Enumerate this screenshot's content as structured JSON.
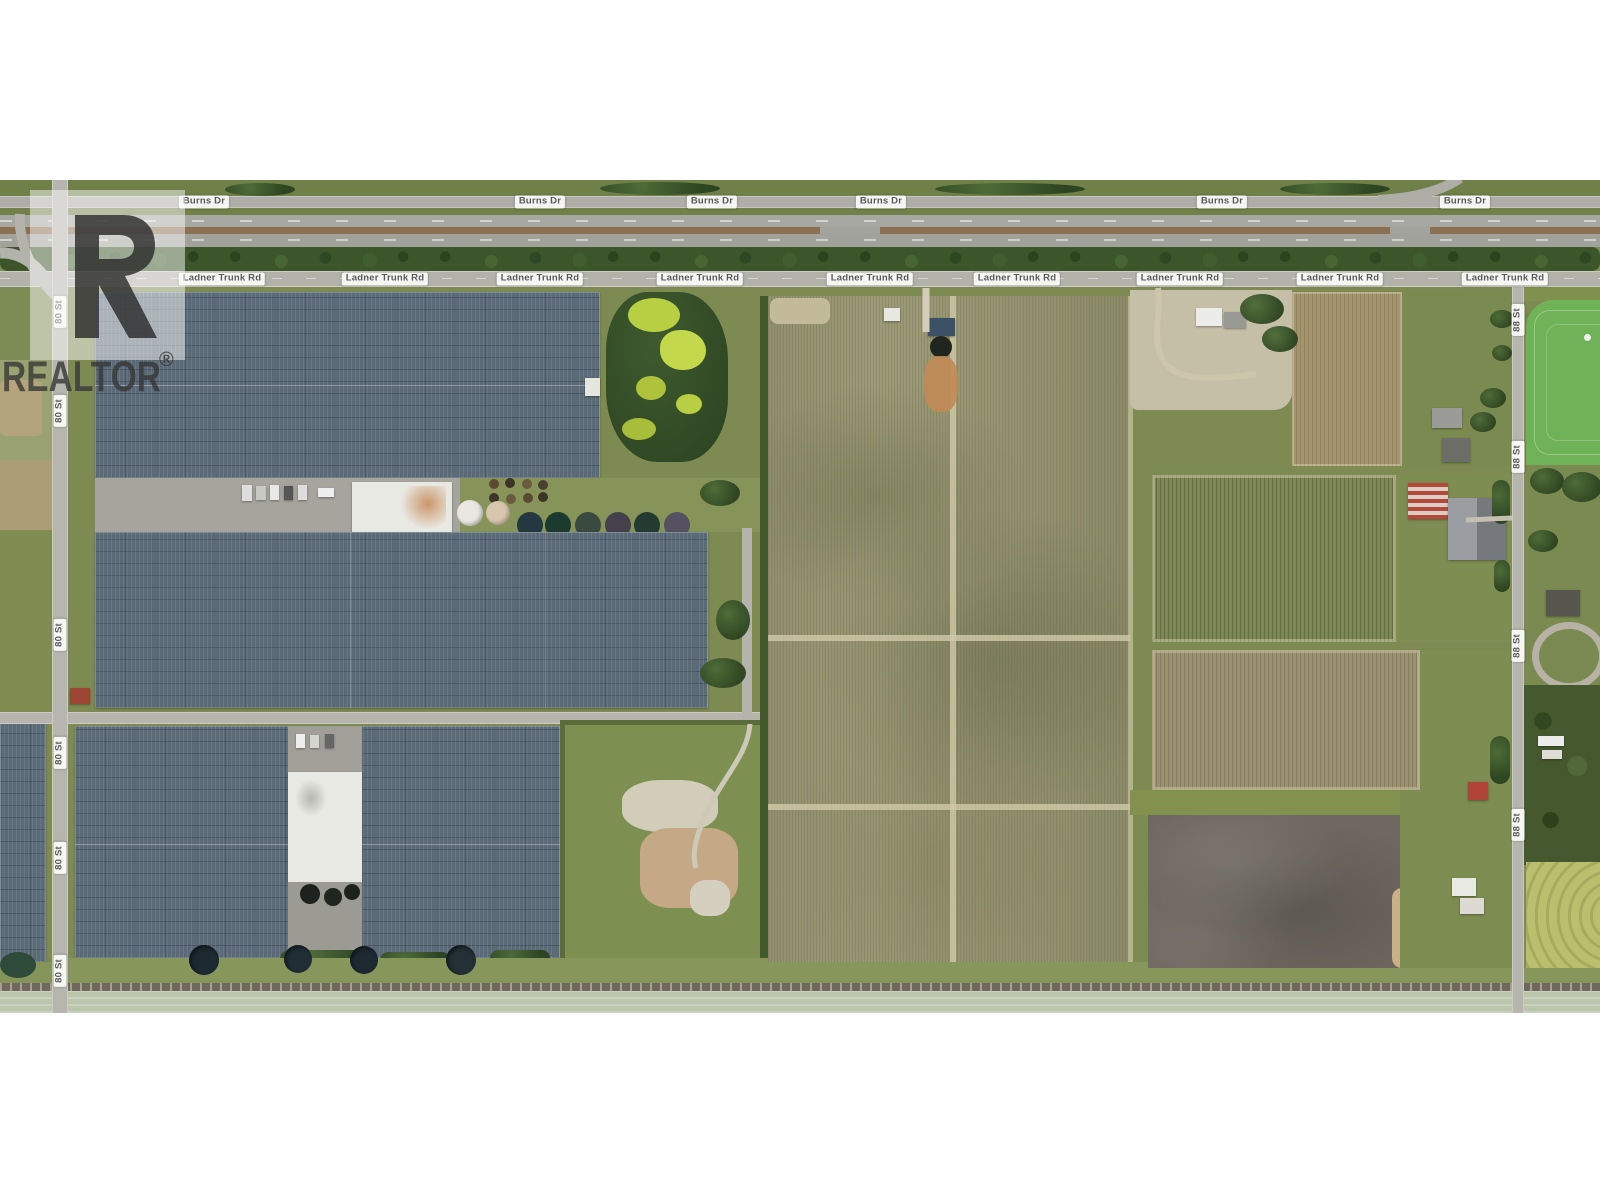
{
  "watermark": {
    "logo_letter": "R",
    "brand": "REALTOR",
    "registered_mark": "®"
  },
  "road_labels": {
    "burns_dr": "Burns Dr",
    "ladner_trunk_rd": "Ladner Trunk Rd",
    "street_80": "80 St",
    "street_88": "88 St"
  },
  "palette": {
    "greenhouse_roof": "#5a6a77",
    "field_tan": "#9d9a77",
    "grass_green": "#7d8b52",
    "tree_green": "#3c5629",
    "algae_green": "#b9cf43",
    "bare_soil": "#6f6861",
    "road_gray": "#b3b2ab",
    "bright_pasture": "#6fb257",
    "label_text": "#595959"
  }
}
